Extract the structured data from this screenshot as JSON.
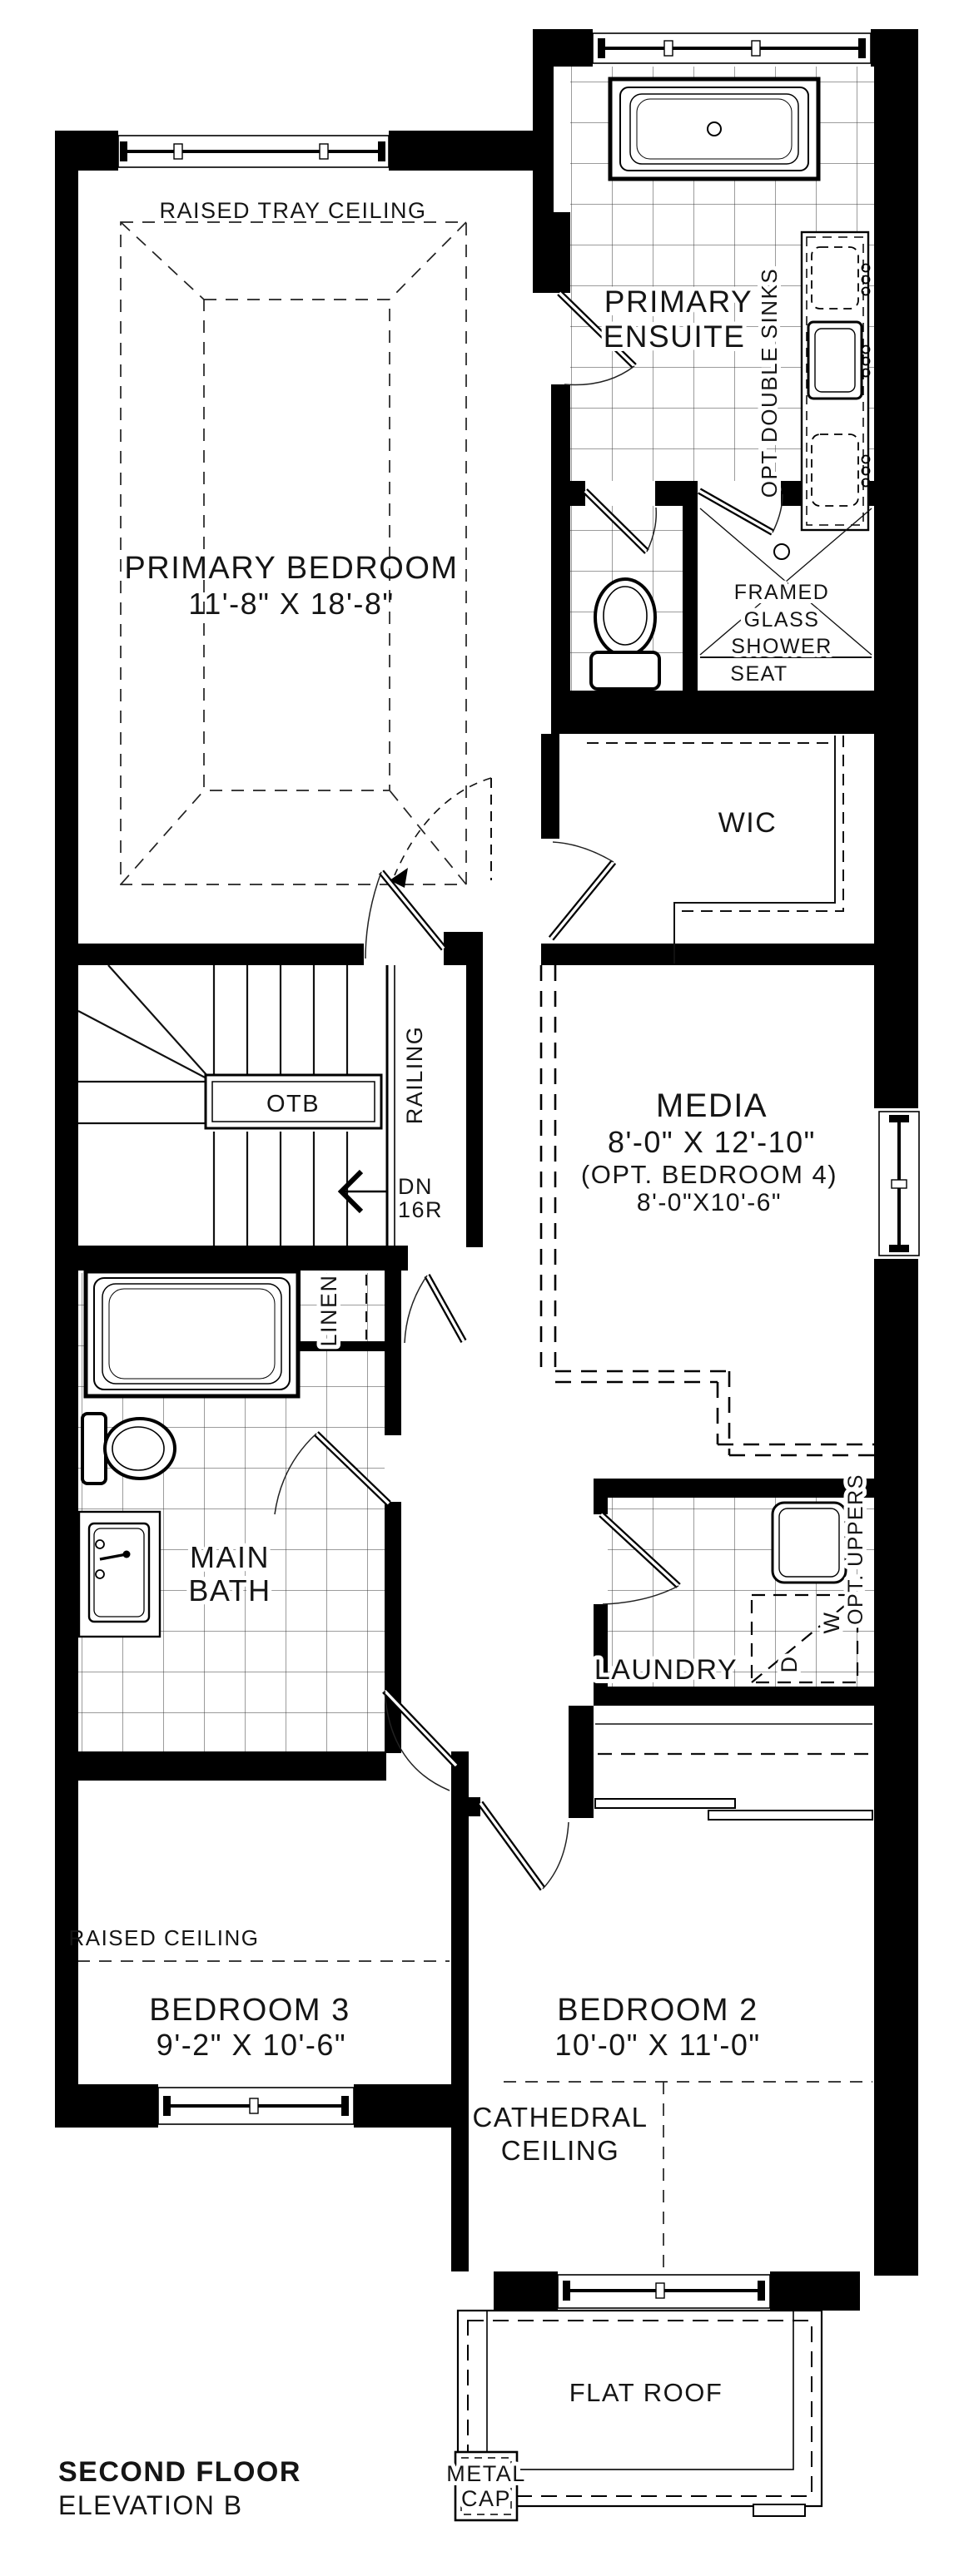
{
  "plan": {
    "title": "SECOND FLOOR",
    "subtitle": "ELEVATION B",
    "colors": {
      "wall": "#000000",
      "text": "#151515",
      "bg": "#ffffff"
    },
    "rooms": {
      "primary_bedroom": {
        "name": "PRIMARY BEDROOM",
        "dims": "11'-8\" X 18'-8\"",
        "ceiling_note": "RAISED TRAY CEILING"
      },
      "primary_ensuite": {
        "name1": "PRIMARY",
        "name2": "ENSUITE",
        "opt_note": "OPT DOUBLE SINKS"
      },
      "shower": {
        "note1": "FRAMED",
        "note2": "GLASS",
        "note3": "SHOWER",
        "seat": "SEAT"
      },
      "wic": {
        "name": "WIC"
      },
      "stairs": {
        "otb": "OTB",
        "railing": "RAILING",
        "down": "DN",
        "risers": "16R"
      },
      "media": {
        "name": "MEDIA",
        "dims": "8'-0\" X 12'-10\"",
        "opt": "(OPT. BEDROOM 4)",
        "opt_dims": "8'-0\"X10'-6\""
      },
      "linen": {
        "name": "LINEN"
      },
      "main_bath": {
        "name1": "MAIN",
        "name2": "BATH"
      },
      "laundry": {
        "name": "LAUNDRY",
        "opt_note": "OPT. UPPERS",
        "washer": "W",
        "dryer": "D"
      },
      "bedroom_3": {
        "name": "BEDROOM 3",
        "dims": "9'-2\" X 10'-6\"",
        "ceiling_note": "RAISED CEILING"
      },
      "bedroom_2": {
        "name": "BEDROOM 2",
        "dims": "10'-0\" X 11'-0\"",
        "ceiling_note1": "CATHEDRAL",
        "ceiling_note2": "CEILING"
      },
      "roof": {
        "name": "FLAT ROOF",
        "cap1": "METAL",
        "cap2": "CAP"
      }
    }
  }
}
